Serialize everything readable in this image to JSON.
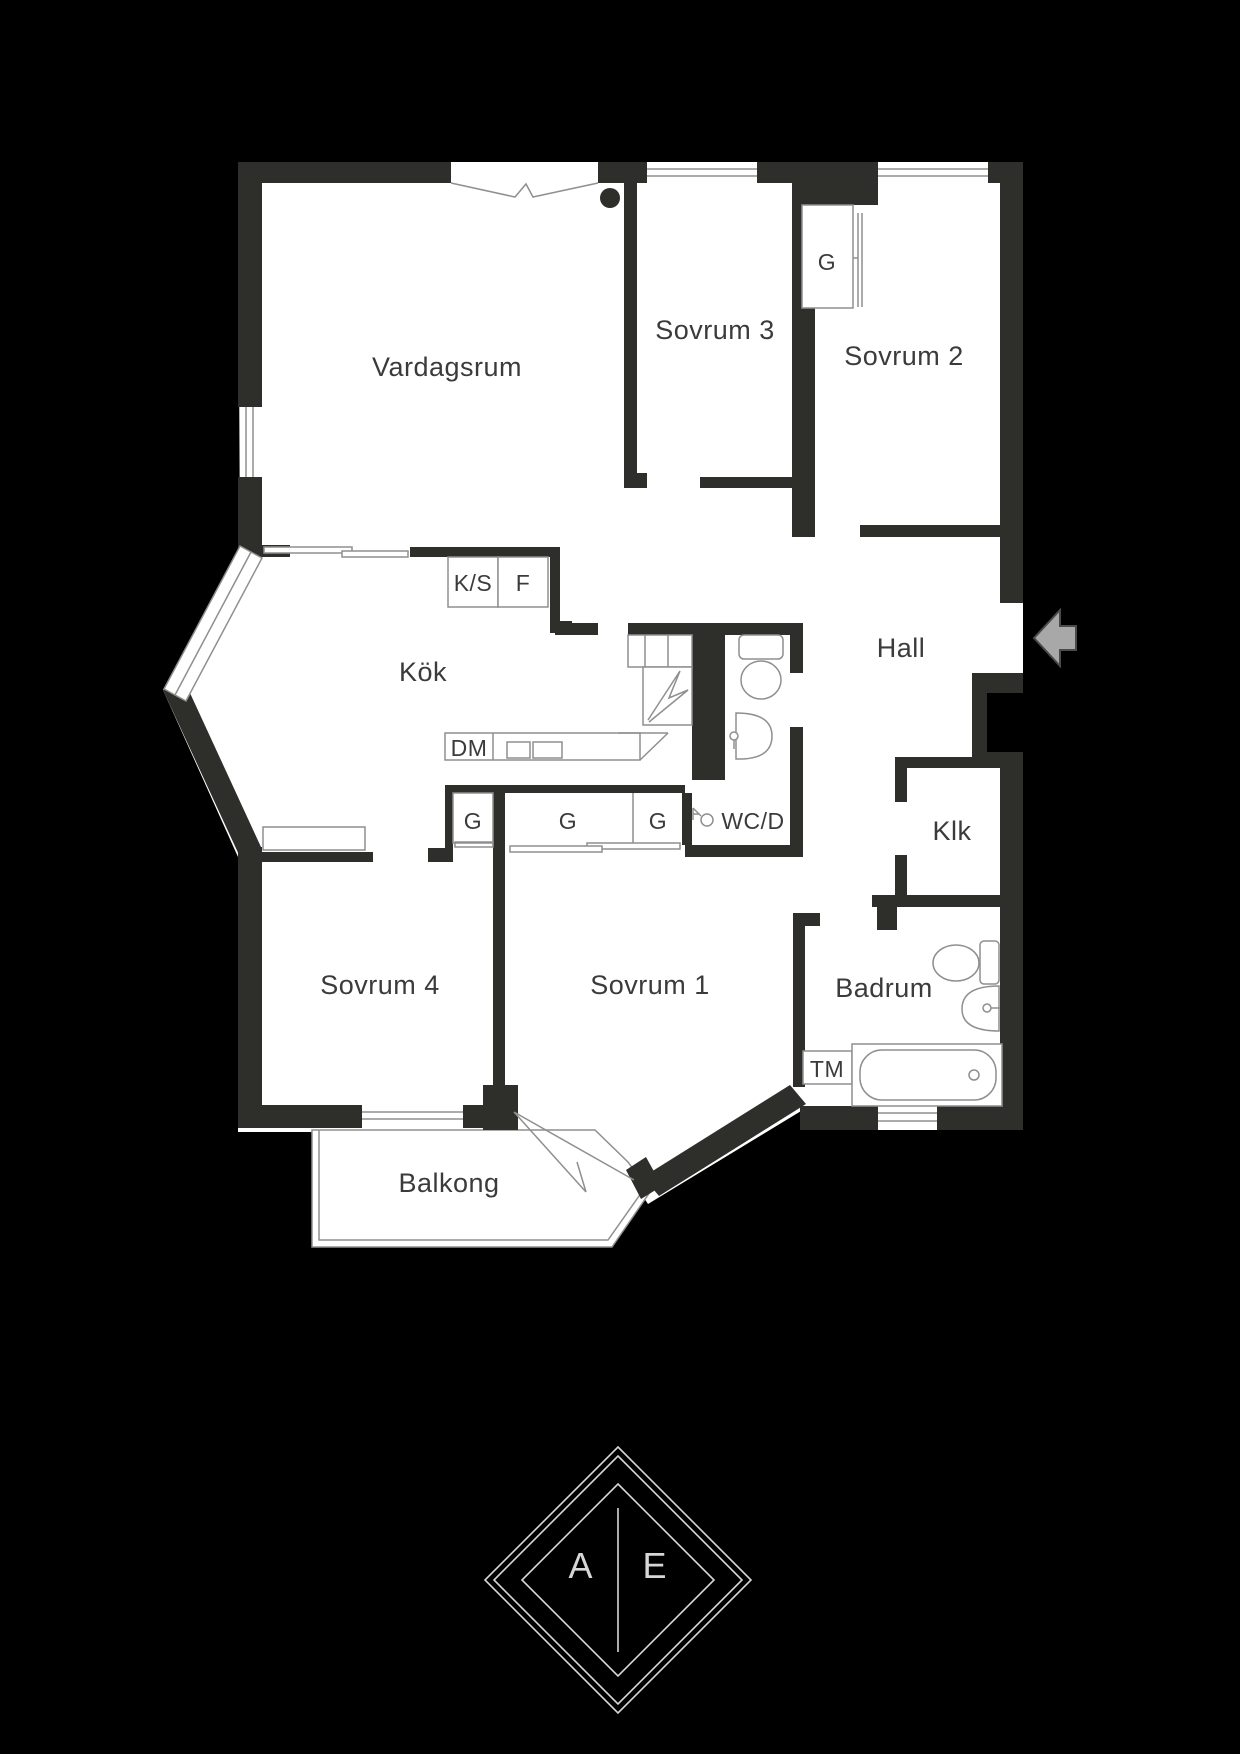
{
  "palette": {
    "background": "#000000",
    "wall": "#2e2e2b",
    "interior": "#ffffff",
    "line": "#8f8f8f",
    "text": "#3b3b3b",
    "arrow_fill": "#a8a8a8",
    "arrow_stroke": "#4a4a4a",
    "logo_line": "#d6d6d6"
  },
  "rooms": {
    "vardagsrum": {
      "label": "Vardagsrum"
    },
    "sovrum3": {
      "label": "Sovrum 3"
    },
    "sovrum2": {
      "label": "Sovrum 2"
    },
    "kok": {
      "label": "Kök"
    },
    "hall": {
      "label": "Hall"
    },
    "klk": {
      "label": "Klk"
    },
    "wcd": {
      "label": "WC/D"
    },
    "badrum": {
      "label": "Badrum"
    },
    "sovrum4": {
      "label": "Sovrum 4"
    },
    "sovrum1": {
      "label": "Sovrum 1"
    },
    "balkong": {
      "label": "Balkong"
    }
  },
  "fixtures": {
    "kyl_sval": {
      "label": "K/S"
    },
    "frys": {
      "label": "F"
    },
    "diskmaskin": {
      "label": "DM"
    },
    "tvattmaskin": {
      "label": "TM"
    },
    "garderob_sovrum2": {
      "label": "G"
    },
    "garderob_1": {
      "label": "G"
    },
    "garderob_2": {
      "label": "G"
    },
    "garderob_3": {
      "label": "G"
    }
  },
  "logo": {
    "left_letter": "A",
    "right_letter": "E"
  }
}
